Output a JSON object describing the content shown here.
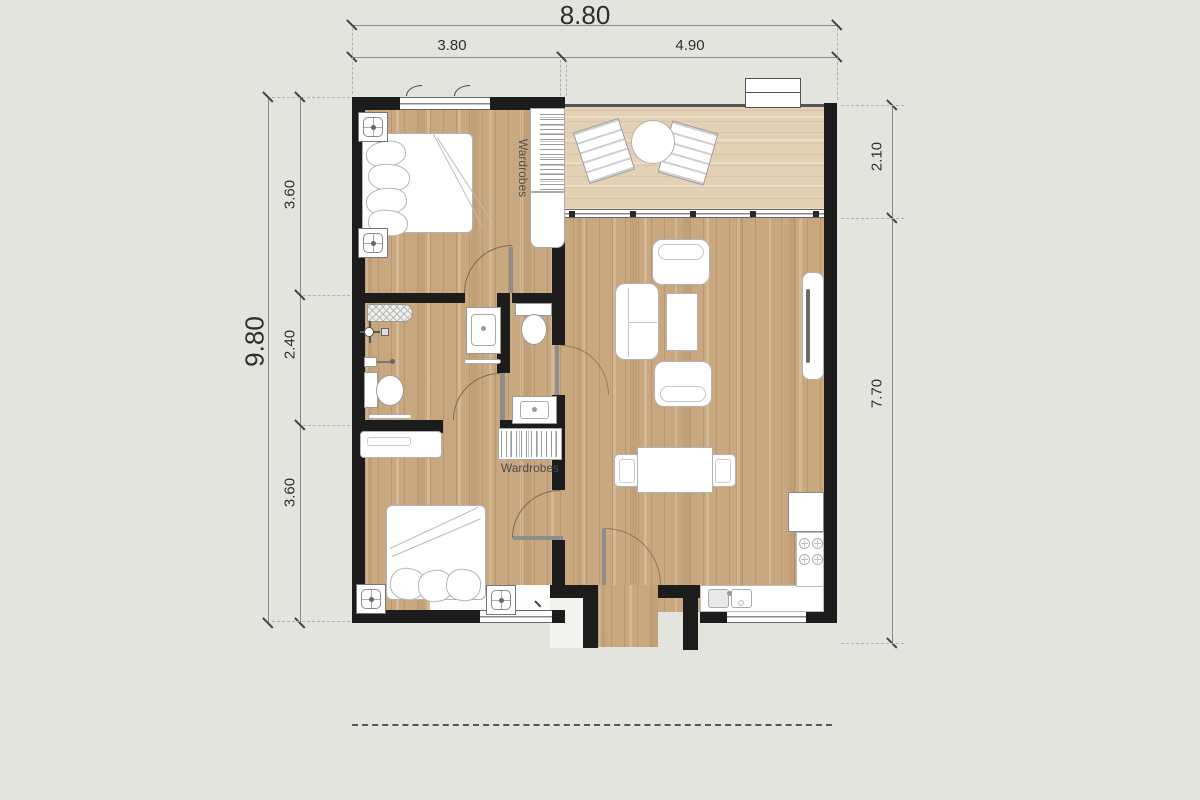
{
  "drawing": {
    "type": "floor-plan",
    "dimensions": {
      "top": {
        "overall": "8.80",
        "segments": [
          "3.80",
          "4.90"
        ]
      },
      "left": {
        "overall": "9.80",
        "segments": [
          "3.60",
          "2.40",
          "3.60"
        ]
      },
      "right": {
        "segments": [
          "2.10",
          "7.70"
        ]
      }
    },
    "labels": {
      "wardrobes_bedroom1": "Wardrobes",
      "wardrobes_bedroom2": "Wardrobes"
    },
    "colors": {
      "background": "#e4e4de",
      "wall": "#1c1c1c",
      "floor_wood": "#c9a87f",
      "floor_balcony": "#e3d0b5",
      "fixture_outline": "#9a9a9a",
      "dimension_text": "#2e2e2e"
    }
  }
}
